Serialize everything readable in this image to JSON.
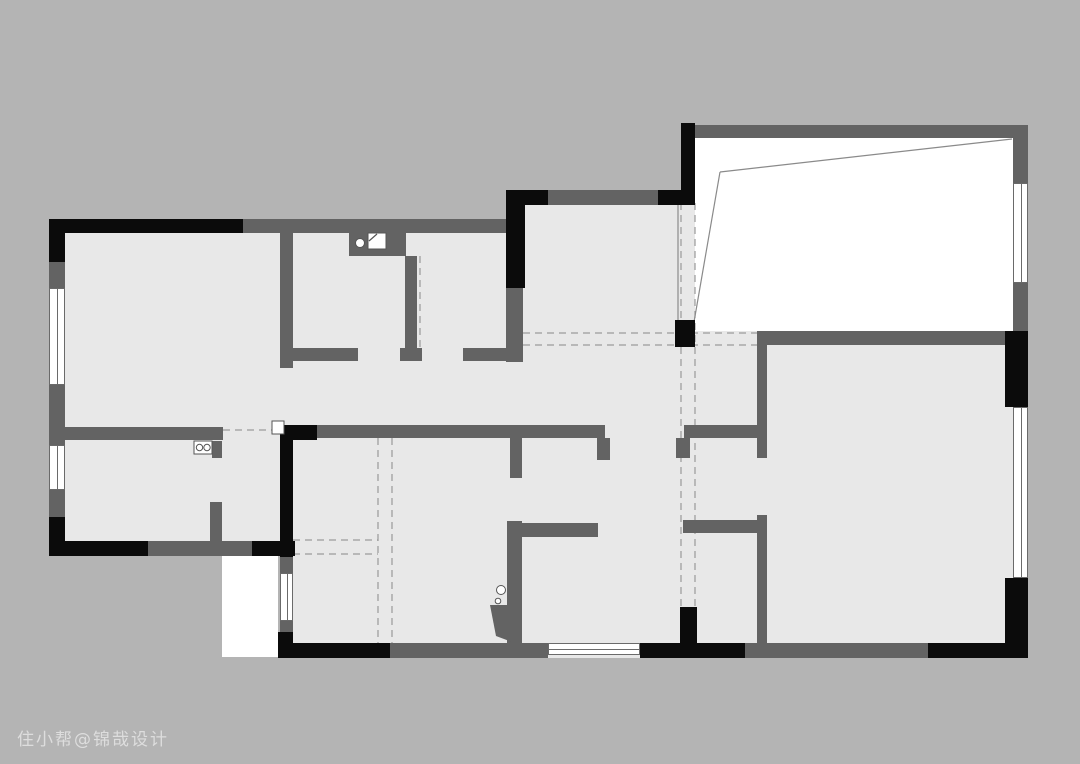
{
  "canvas": {
    "width": 1080,
    "height": 764
  },
  "colors": {
    "background": "#b4b4b4",
    "floor": "#e8e8e8",
    "wall_gray": "#636363",
    "wall_black": "#0b0b0b",
    "white": "#ffffff",
    "dashed_line": "#9a9a9a",
    "thin_line": "#8a8a8a",
    "fixture_stroke": "#555555"
  },
  "watermark": {
    "text": "住小帮@锦哉设计",
    "x": 17,
    "y": 725
  },
  "floor_plan": {
    "floors": [
      [
        49,
        219,
        474,
        337
      ],
      [
        280,
        425,
        242,
        233
      ],
      [
        506,
        190,
        191,
        158
      ],
      [
        500,
        345,
        267,
        313
      ],
      [
        695,
        331,
        333,
        327
      ]
    ],
    "white_areas": [
      {
        "name": "sun-room-floor",
        "rect": [
          695,
          138,
          318,
          193
        ]
      },
      {
        "name": "stairwell",
        "rect": [
          222,
          555,
          56,
          102
        ]
      }
    ],
    "walls_black": [
      [
        49,
        219,
        194,
        14
      ],
      [
        49,
        219,
        16,
        43
      ],
      [
        506,
        190,
        42,
        15
      ],
      [
        506,
        190,
        19,
        98
      ],
      [
        658,
        190,
        37,
        15
      ],
      [
        681,
        123,
        14,
        80
      ],
      [
        675,
        320,
        20,
        27
      ],
      [
        1005,
        331,
        23,
        76
      ],
      [
        1005,
        578,
        23,
        80
      ],
      [
        928,
        643,
        100,
        15
      ],
      [
        640,
        643,
        105,
        15
      ],
      [
        680,
        607,
        17,
        36
      ],
      [
        278,
        643,
        112,
        15
      ],
      [
        278,
        632,
        15,
        26
      ],
      [
        280,
        425,
        37,
        15
      ],
      [
        280,
        425,
        13,
        132
      ],
      [
        49,
        541,
        99,
        15
      ],
      [
        252,
        541,
        43,
        15
      ],
      [
        49,
        517,
        16,
        39
      ]
    ],
    "walls_gray": [
      [
        243,
        219,
        263,
        14
      ],
      [
        548,
        190,
        110,
        15
      ],
      [
        695,
        125,
        333,
        13
      ],
      [
        1013,
        138,
        15,
        45
      ],
      [
        1013,
        283,
        15,
        48
      ],
      [
        757,
        331,
        248,
        14
      ],
      [
        49,
        262,
        16,
        26
      ],
      [
        49,
        385,
        16,
        60
      ],
      [
        49,
        490,
        16,
        27
      ],
      [
        280,
        232,
        13,
        136
      ],
      [
        349,
        232,
        57,
        24
      ],
      [
        405,
        256,
        12,
        92
      ],
      [
        293,
        348,
        65,
        13
      ],
      [
        400,
        348,
        22,
        13
      ],
      [
        463,
        348,
        47,
        13
      ],
      [
        506,
        288,
        17,
        74
      ],
      [
        49,
        427,
        174,
        13
      ],
      [
        317,
        425,
        288,
        13
      ],
      [
        597,
        438,
        13,
        22
      ],
      [
        684,
        425,
        79,
        13
      ],
      [
        676,
        438,
        14,
        20
      ],
      [
        522,
        523,
        76,
        14
      ],
      [
        507,
        521,
        15,
        122
      ],
      [
        683,
        520,
        80,
        13
      ],
      [
        757,
        345,
        10,
        113
      ],
      [
        757,
        515,
        10,
        128
      ],
      [
        510,
        438,
        12,
        40
      ],
      [
        212,
        441,
        10,
        17
      ],
      [
        210,
        502,
        12,
        41
      ],
      [
        148,
        541,
        104,
        15
      ],
      [
        280,
        557,
        13,
        16
      ],
      [
        280,
        621,
        13,
        11
      ],
      [
        390,
        643,
        158,
        15
      ],
      [
        745,
        643,
        183,
        15
      ]
    ],
    "windows": [
      {
        "rect": [
          49,
          288,
          16,
          97
        ],
        "dir": "v"
      },
      {
        "rect": [
          49,
          445,
          16,
          45
        ],
        "dir": "v"
      },
      {
        "rect": [
          280,
          573,
          13,
          48
        ],
        "dir": "v"
      },
      {
        "rect": [
          548,
          643,
          92,
          12
        ],
        "dir": "h"
      },
      {
        "rect": [
          1013,
          183,
          15,
          100
        ],
        "dir": "v"
      },
      {
        "rect": [
          1013,
          407,
          15,
          171
        ],
        "dir": "v"
      }
    ],
    "dashed_lines": [
      [
        523,
        333,
        757,
        333
      ],
      [
        523,
        345,
        757,
        345
      ],
      [
        681,
        203,
        681,
        607
      ],
      [
        695,
        203,
        695,
        607
      ],
      [
        378,
        438,
        378,
        643
      ],
      [
        392,
        438,
        392,
        643
      ],
      [
        293,
        540,
        378,
        540
      ],
      [
        293,
        554,
        378,
        554
      ],
      [
        223,
        430,
        277,
        430
      ],
      [
        420,
        256,
        420,
        348
      ]
    ],
    "thin_lines": [
      [
        720,
        172,
        1012,
        139
      ],
      [
        720,
        172,
        694,
        322
      ],
      [
        678,
        203,
        678,
        322
      ]
    ],
    "fixtures": {
      "sink_circle": {
        "cx": 360,
        "cy": 243,
        "r": 4.5
      },
      "stove_square": {
        "rect": [
          368,
          233,
          18,
          16
        ],
        "fold": [
          369,
          241,
          377,
          234
        ]
      },
      "utility_appliance": {
        "rect": [
          194,
          441,
          18,
          13
        ],
        "circles": [
          [
            199.5,
            447.5,
            3.2
          ],
          [
            207,
            447.5,
            3.2
          ]
        ]
      },
      "bath_circles": [
        [
          501,
          590,
          4.5
        ],
        [
          498,
          601,
          2.8
        ]
      ],
      "bath_tray": [
        [
          490,
          605
        ],
        [
          512,
          605
        ],
        [
          512,
          642
        ],
        [
          496,
          636
        ]
      ],
      "door_plate": {
        "rect": [
          272,
          421,
          12,
          13
        ]
      }
    }
  }
}
